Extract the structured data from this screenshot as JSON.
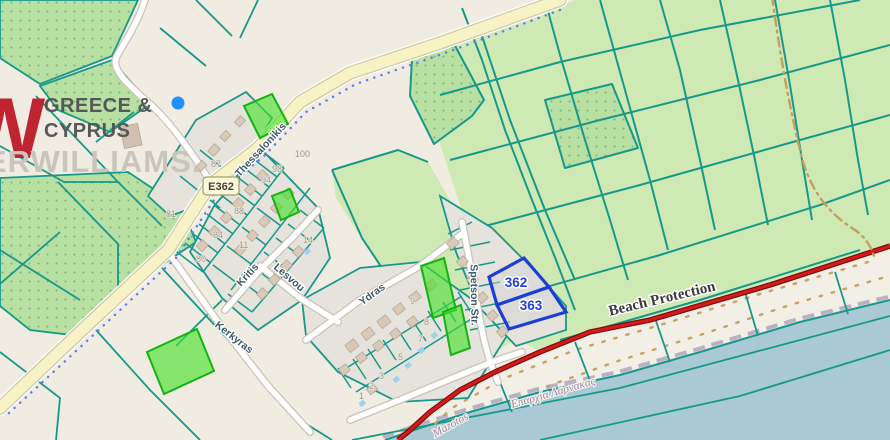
{
  "brand": {
    "monogram": "W",
    "region_top": "GREECE &",
    "region_bottom": "CYPRUS",
    "watermark": "ERWILLIAMS."
  },
  "badges": {
    "route": "E362"
  },
  "selection": {
    "parcel_a": "362",
    "parcel_b": "363"
  },
  "streets": {
    "thessalonikis": "Thessalonikis",
    "kritis": "Kritis",
    "lesvou": "Lesvou",
    "kerkyras": "Kerkyras",
    "ydras": "Ydras",
    "spetson": "Spetson Str."
  },
  "zones": {
    "beach_protection": "Beach Protection",
    "district": "Επαρχία Λάρνακας",
    "locality": "Mazotos"
  },
  "parcel_numbers": {
    "n100": "100",
    "n98": "98",
    "n94": "94",
    "n88": "88",
    "n87": "87",
    "n84": "84",
    "n81": "81",
    "n80": "80",
    "n14": "14",
    "n11": "11",
    "n9": "9",
    "n8": "8",
    "n7": "7",
    "n5": "5",
    "n3": "3",
    "n2": "2",
    "n1": "1"
  },
  "colors": {
    "land": "#f0ece1",
    "field_green": "#cfe9b4",
    "orchard_green": "#b7e0a2",
    "parcel_line": "#17988b",
    "road_yellow": "#f7f3c6",
    "highlight_green": "#45e028",
    "highlight_green_border": "#12b312",
    "selection_blue": "#1d3ed6",
    "beach_red": "#d61a1a",
    "water": "#a9c9d5",
    "boundary_tan": "#c79e60",
    "marker_blue": "#1e90ff"
  }
}
